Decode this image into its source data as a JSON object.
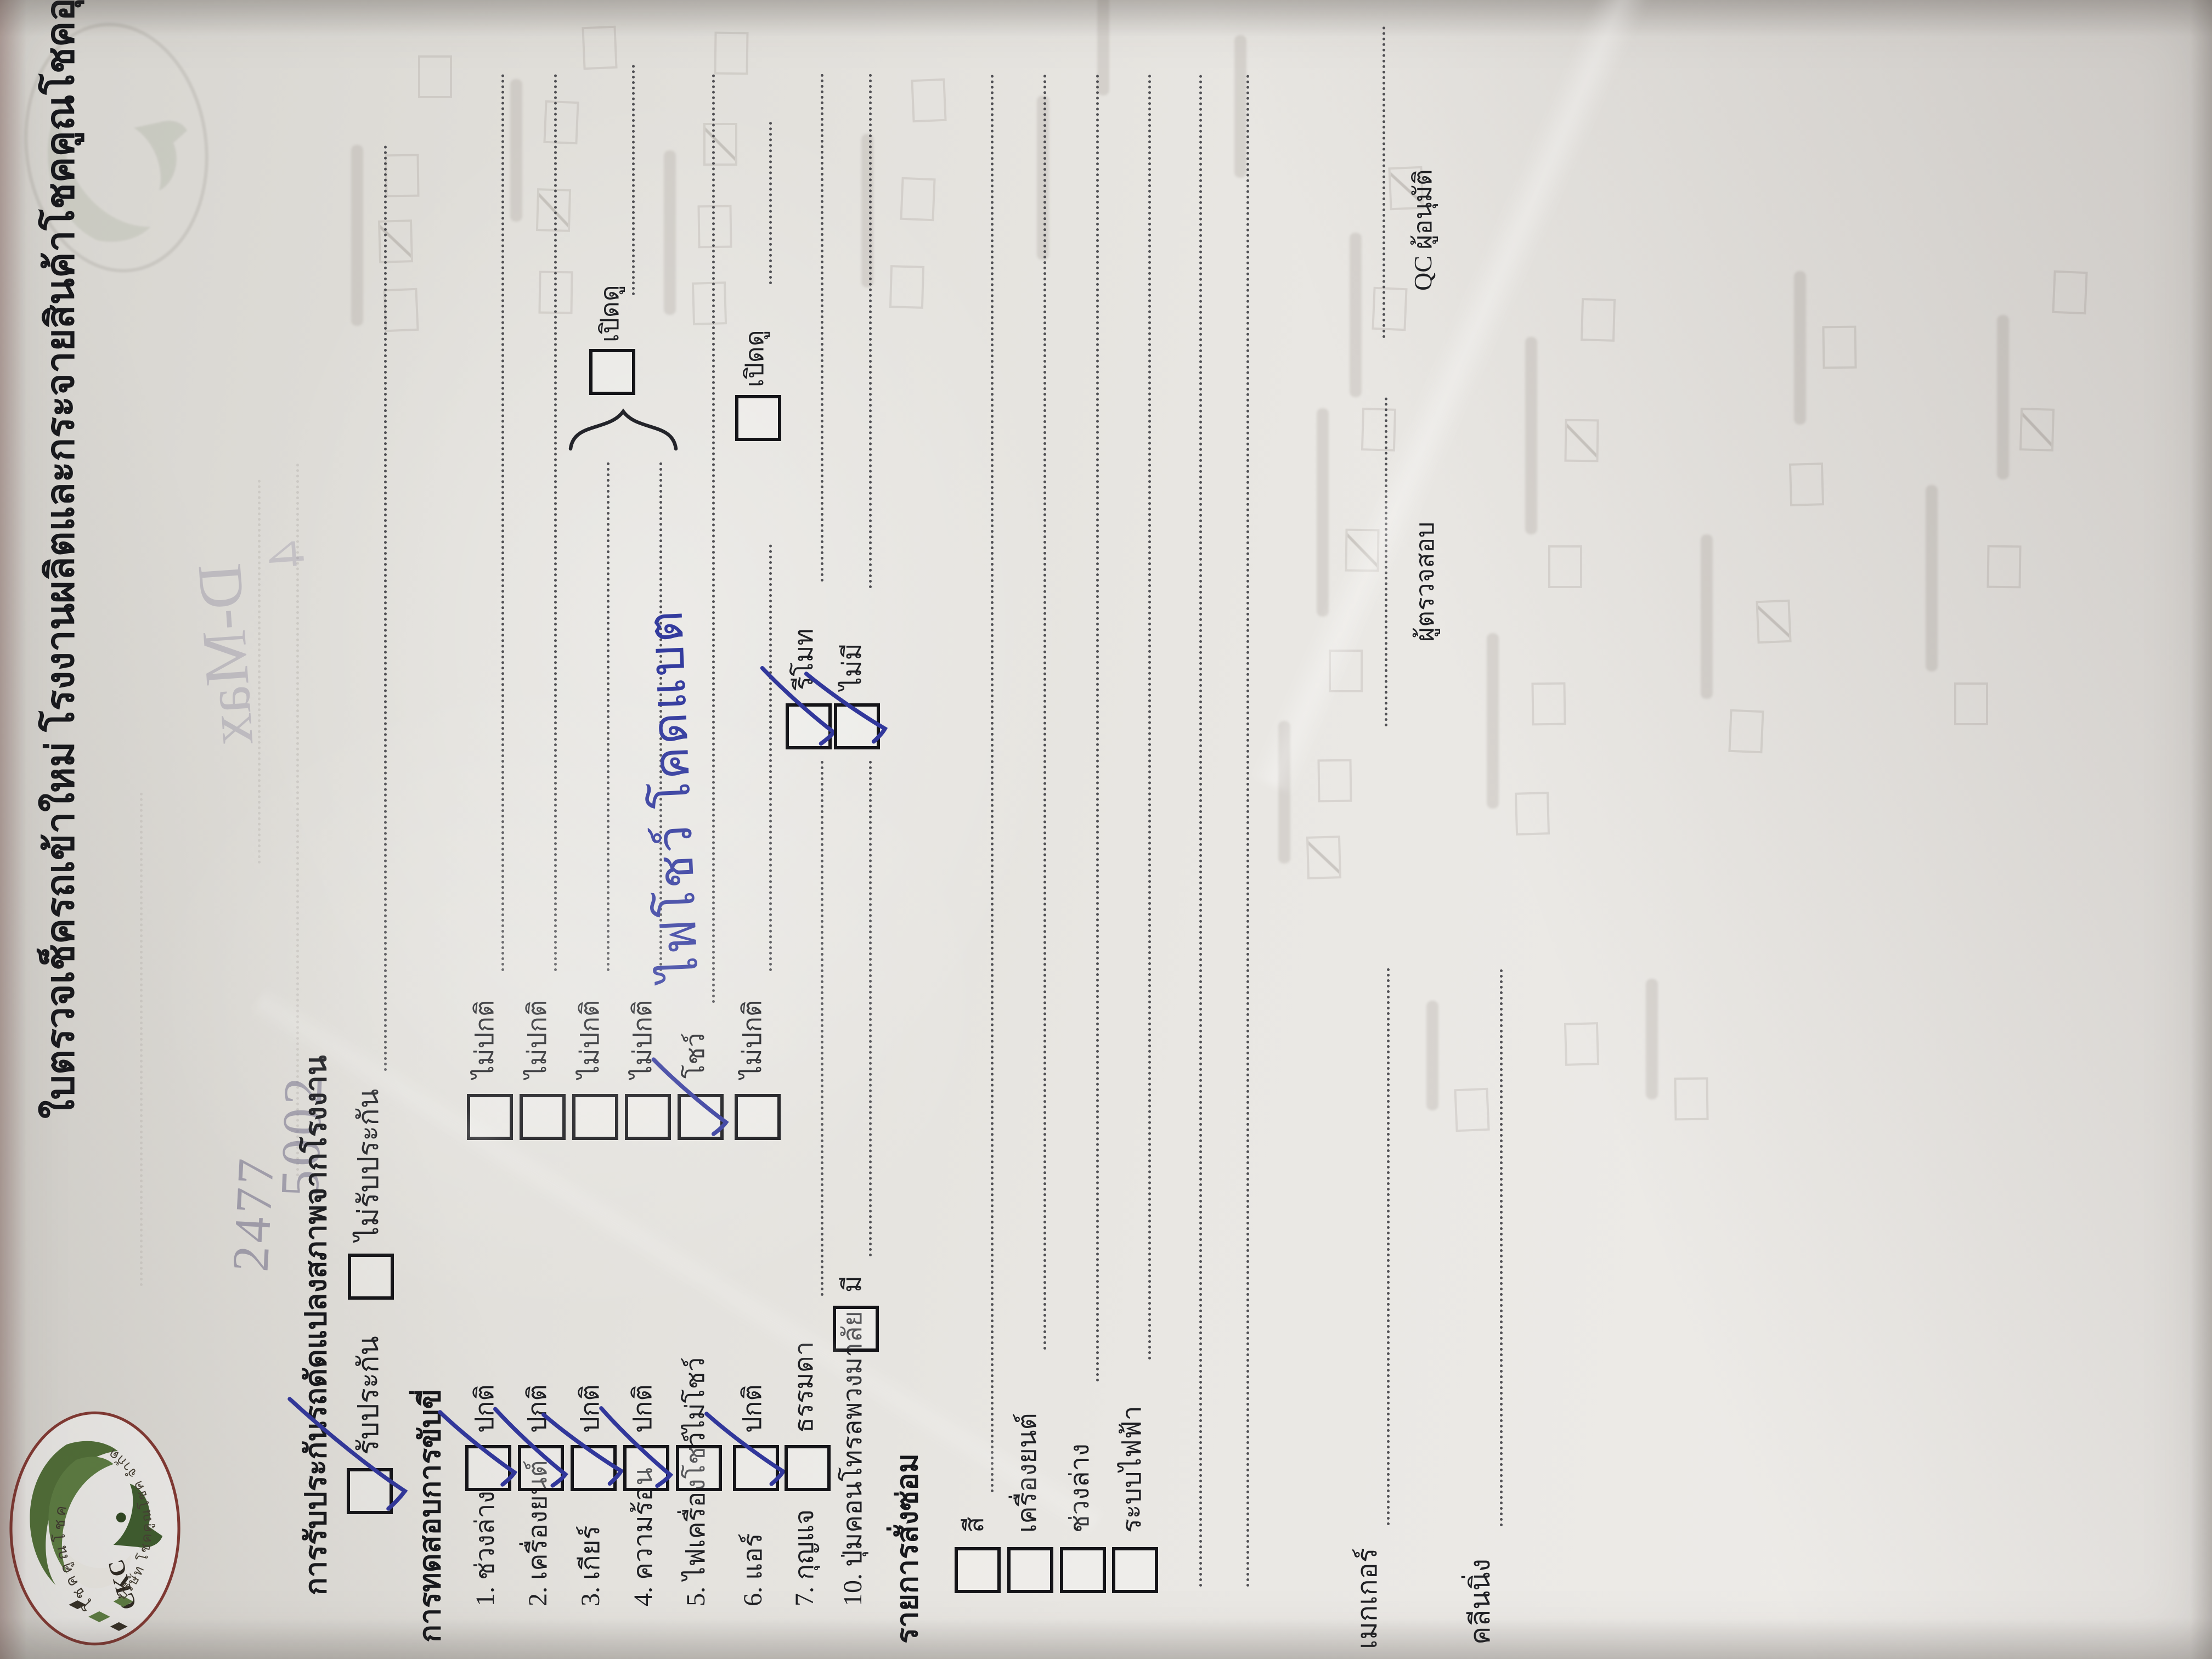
{
  "title": "ใบตรวจเช็ครถเข้าใหม่ โรงงานผลิตและกระจายสินค้าโชคคูณโชคอุดร",
  "logo": {
    "monogram": "CKC",
    "arc_top": "โชคคูณโชค",
    "arc_bottom": "บริษัท โชคคูณโชค จำกัด"
  },
  "warranty": {
    "header": "การรับประกันรถดัดแปลงสภาพจากโรงงาน",
    "option_yes": "รับประกัน",
    "yes_checked": true,
    "option_no": "ไม่รับประกัน",
    "no_checked": false
  },
  "test": {
    "header": "การทดสอบการขับขี่",
    "open_check_label": "เปิดดู",
    "items": [
      {
        "label": "1. ช่วงล่าง",
        "opt1": "ปกติ",
        "opt1_checked": true,
        "opt2": "ไม่ปกติ",
        "opt2_checked": false
      },
      {
        "label": "2. เครื่องยนต์",
        "opt1": "ปกติ",
        "opt1_checked": true,
        "opt2": "ไม่ปกติ",
        "opt2_checked": false
      },
      {
        "label": "3. เกียร์",
        "opt1": "ปกติ",
        "opt1_checked": true,
        "opt2": "ไม่ปกติ",
        "opt2_checked": false
      },
      {
        "label": "4. ความร้อน",
        "opt1": "ปกติ",
        "opt1_checked": true,
        "opt2": "ไม่ปกติ",
        "opt2_checked": false
      },
      {
        "label": "5. ไฟเครื่องโชว์",
        "opt1": "ไม่โชว์",
        "opt1_checked": false,
        "opt2": "โชว์",
        "opt2_checked": true,
        "note": "ไฟโชว์ โคดแบต"
      },
      {
        "label": "6. แอร์",
        "opt1": "ปกติ",
        "opt1_checked": true,
        "opt2": "ไม่ปกติ",
        "opt2_checked": false
      },
      {
        "label": "7. กุญแจ",
        "opt1": "ธรรมดา",
        "opt1_checked": false,
        "opt2": "รีโมท",
        "opt2_checked": true
      },
      {
        "label": "10. ปุ่มคอนโทรลพวงมาลัย",
        "opt1": "มี",
        "opt1_checked": false,
        "opt2": "ไม่มี",
        "opt2_checked": true
      }
    ]
  },
  "repair": {
    "header": "รายการสั่งซ่อม",
    "rows": [
      "สี",
      "เครื่องยนต์",
      "ช่วงล่าง",
      "ระบบไฟฟ้า"
    ]
  },
  "signatures": {
    "maker": "เมกเกอร์",
    "cleaning": "คลีนนิ่ง",
    "inspector": "ผู้ตรวจสอบ",
    "approver": "QC ผู้อนุมัติ"
  },
  "handwriting": {
    "ink_color": "#333b9e",
    "pencil_notes": [
      "2477",
      "5002"
    ],
    "mirror_notes": [
      "D-Max",
      "4"
    ]
  }
}
